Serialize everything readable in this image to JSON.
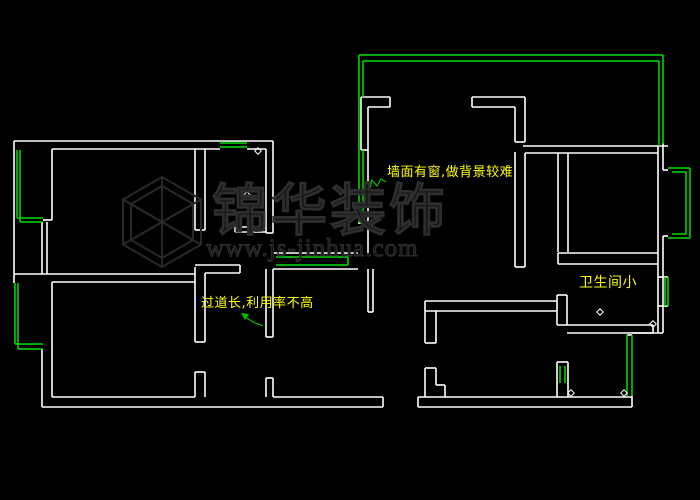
{
  "canvas": {
    "width": 700,
    "height": 500,
    "background": "#000000"
  },
  "colors": {
    "wall": "#ffffff",
    "window": "#00e000",
    "leader": "#00c000",
    "annotation": "#ffff00",
    "watermark": "#2e2e2e"
  },
  "annotations": [
    {
      "text": "墙面有窗,做背景较难",
      "x": 387,
      "y": 166,
      "size": 13
    },
    {
      "text": "过道长,利用率不高",
      "x": 201,
      "y": 297,
      "size": 13
    },
    {
      "text": "卫生间小",
      "x": 579,
      "y": 276,
      "size": 14
    }
  ],
  "watermark": {
    "brand": "锦华装饰",
    "url": "www.js-jinhua.com"
  },
  "geometry": {
    "walls": [
      [
        14,
        141,
        273,
        141
      ],
      [
        52,
        149,
        220,
        149
      ],
      [
        247,
        149,
        266,
        149
      ],
      [
        14,
        141,
        14,
        283
      ],
      [
        52,
        149,
        52,
        220
      ],
      [
        43,
        220,
        52,
        220
      ],
      [
        42,
        222,
        42,
        274
      ],
      [
        47,
        222,
        47,
        274
      ],
      [
        14,
        274,
        195,
        274
      ],
      [
        52,
        282,
        195,
        282
      ],
      [
        52,
        282,
        52,
        397
      ],
      [
        42,
        349,
        42,
        407
      ],
      [
        52,
        397,
        195,
        397
      ],
      [
        42,
        407,
        383,
        407
      ],
      [
        273,
        397,
        383,
        397
      ],
      [
        383,
        397,
        383,
        407
      ],
      [
        195,
        149,
        195,
        230
      ],
      [
        205,
        149,
        205,
        230
      ],
      [
        195,
        230,
        205,
        230
      ],
      [
        195,
        267,
        195,
        342
      ],
      [
        205,
        273,
        205,
        342
      ],
      [
        195,
        342,
        205,
        342
      ],
      [
        195,
        372,
        195,
        397
      ],
      [
        205,
        372,
        205,
        397
      ],
      [
        195,
        372,
        205,
        372
      ],
      [
        266,
        149,
        266,
        233
      ],
      [
        273,
        141,
        273,
        233
      ],
      [
        266,
        233,
        273,
        233
      ],
      [
        266,
        269,
        266,
        337
      ],
      [
        273,
        269,
        273,
        337
      ],
      [
        266,
        337,
        273,
        337
      ],
      [
        266,
        378,
        266,
        397
      ],
      [
        273,
        378,
        273,
        397
      ],
      [
        266,
        378,
        273,
        378
      ],
      [
        235,
        227,
        266,
        227
      ],
      [
        235,
        232,
        266,
        232
      ],
      [
        235,
        227,
        235,
        232
      ],
      [
        195,
        265,
        240,
        265
      ],
      [
        205,
        273,
        240,
        273
      ],
      [
        240,
        265,
        240,
        273
      ],
      [
        273,
        253,
        358,
        253
      ],
      [
        273,
        269,
        358,
        269
      ],
      [
        361,
        97,
        390,
        97
      ],
      [
        390,
        97,
        390,
        107
      ],
      [
        368,
        107,
        390,
        107
      ],
      [
        361,
        97,
        361,
        150
      ],
      [
        368,
        107,
        368,
        150
      ],
      [
        361,
        150,
        368,
        150
      ],
      [
        368,
        150,
        368,
        253
      ],
      [
        358,
        223,
        368,
        223
      ],
      [
        368,
        269,
        368,
        312
      ],
      [
        373,
        269,
        373,
        312
      ],
      [
        368,
        312,
        373,
        312
      ],
      [
        472,
        97,
        525,
        97
      ],
      [
        472,
        107,
        515,
        107
      ],
      [
        472,
        97,
        472,
        107
      ],
      [
        515,
        107,
        515,
        142
      ],
      [
        525,
        97,
        525,
        142
      ],
      [
        515,
        142,
        525,
        142
      ],
      [
        515,
        152,
        515,
        267
      ],
      [
        525,
        153,
        525,
        267
      ],
      [
        515,
        267,
        525,
        267
      ],
      [
        523,
        146,
        668,
        146
      ],
      [
        525,
        153,
        658,
        153
      ],
      [
        558,
        153,
        558,
        252
      ],
      [
        568,
        153,
        568,
        252
      ],
      [
        558,
        253,
        658,
        253
      ],
      [
        558,
        264,
        658,
        264
      ],
      [
        558,
        253,
        558,
        264
      ],
      [
        557,
        295,
        557,
        325
      ],
      [
        567,
        295,
        567,
        325
      ],
      [
        557,
        295,
        567,
        295
      ],
      [
        557,
        325,
        653,
        325
      ],
      [
        567,
        333,
        653,
        333
      ],
      [
        653,
        325,
        653,
        333
      ],
      [
        658,
        146,
        658,
        333
      ],
      [
        663,
        143,
        663,
        170
      ],
      [
        663,
        236,
        663,
        333
      ],
      [
        663,
        170,
        668,
        170
      ],
      [
        663,
        236,
        668,
        236
      ],
      [
        658,
        277,
        668,
        277
      ],
      [
        658,
        306,
        668,
        306
      ],
      [
        632,
        333,
        663,
        333
      ],
      [
        627,
        335,
        632,
        335
      ],
      [
        425,
        301,
        557,
        301
      ],
      [
        425,
        311,
        557,
        311
      ],
      [
        425,
        301,
        425,
        311
      ],
      [
        425,
        311,
        425,
        343
      ],
      [
        436,
        311,
        436,
        343
      ],
      [
        425,
        343,
        436,
        343
      ],
      [
        425,
        368,
        425,
        397
      ],
      [
        436,
        368,
        436,
        385
      ],
      [
        436,
        385,
        445,
        385
      ],
      [
        445,
        385,
        445,
        397
      ],
      [
        425,
        368,
        436,
        368
      ],
      [
        418,
        397,
        632,
        397
      ],
      [
        418,
        407,
        632,
        407
      ],
      [
        418,
        397,
        418,
        407
      ],
      [
        632,
        396,
        632,
        407
      ],
      [
        557,
        362,
        557,
        397
      ],
      [
        568,
        362,
        568,
        397
      ],
      [
        557,
        362,
        568,
        362
      ]
    ],
    "windows": [
      [
        17,
        150,
        17,
        218
      ],
      [
        17,
        218,
        43,
        218
      ],
      [
        20,
        150,
        20,
        222
      ],
      [
        20,
        222,
        43,
        222
      ],
      [
        220,
        143,
        247,
        143
      ],
      [
        220,
        147,
        247,
        147
      ],
      [
        15,
        283,
        15,
        344
      ],
      [
        15,
        344,
        43,
        344
      ],
      [
        18,
        283,
        18,
        349
      ],
      [
        18,
        349,
        43,
        349
      ],
      [
        276,
        257,
        348,
        257
      ],
      [
        276,
        265,
        348,
        265
      ],
      [
        348,
        257,
        348,
        265
      ],
      [
        359,
        55,
        663,
        55
      ],
      [
        363,
        61,
        659,
        61
      ],
      [
        359,
        55,
        359,
        223
      ],
      [
        363,
        61,
        363,
        97
      ],
      [
        363,
        150,
        363,
        223
      ],
      [
        663,
        55,
        663,
        144
      ],
      [
        659,
        61,
        659,
        146
      ],
      [
        668,
        168,
        690,
        168
      ],
      [
        690,
        168,
        690,
        238
      ],
      [
        668,
        238,
        690,
        238
      ],
      [
        672,
        172,
        686,
        172
      ],
      [
        686,
        172,
        686,
        234
      ],
      [
        672,
        234,
        686,
        234
      ],
      [
        665,
        277,
        665,
        306
      ],
      [
        668,
        277,
        668,
        306
      ],
      [
        627,
        335,
        627,
        396
      ],
      [
        632,
        335,
        632,
        396
      ],
      [
        560,
        366,
        560,
        383
      ],
      [
        565,
        366,
        565,
        383
      ]
    ],
    "markers": [
      [
        258,
        151
      ],
      [
        247,
        195
      ],
      [
        600,
        312
      ],
      [
        653,
        324
      ],
      [
        571,
        393
      ],
      [
        624,
        393
      ]
    ],
    "leaders": [
      {
        "points": [
          [
            386,
            182
          ],
          [
            381,
            179
          ],
          [
            377,
            186
          ],
          [
            372,
            180
          ],
          [
            368,
            184
          ]
        ],
        "arrow": [
          [
            365,
            186
          ],
          [
            372,
            181
          ],
          [
            371,
            188
          ]
        ]
      },
      {
        "points": [
          [
            263,
            326
          ],
          [
            253,
            322
          ],
          [
            244,
            316
          ]
        ],
        "arrow": [
          [
            241,
            313
          ],
          [
            249,
            314
          ],
          [
            245,
            320
          ]
        ]
      }
    ]
  }
}
